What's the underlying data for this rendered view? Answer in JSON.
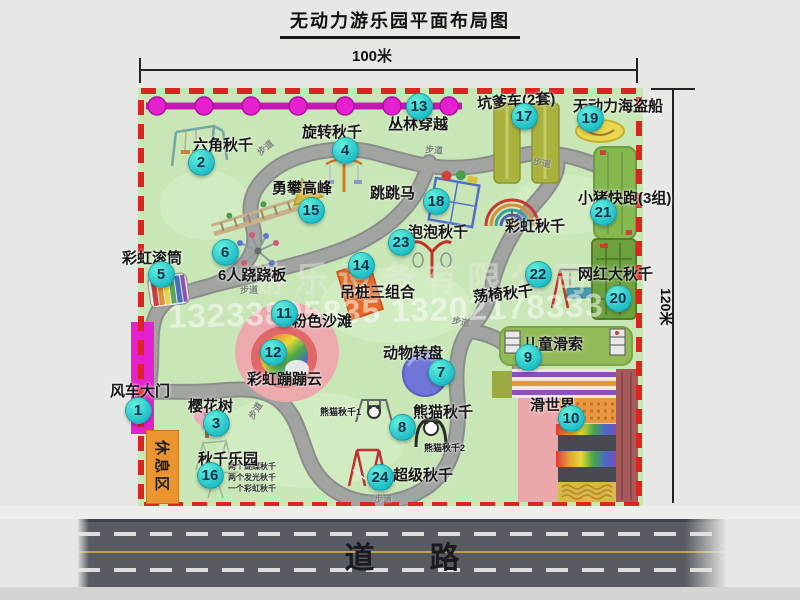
{
  "title": "无动力游乐园平面布局图",
  "dimensions": {
    "top": "100米",
    "right": "120米"
  },
  "road_label": "道路",
  "rest_area_label": "休息区",
  "path_label": "步道",
  "watermark": {
    "company": "游乐设备有限公司",
    "phones": "13233805835 13202178333"
  },
  "attractions": [
    {
      "num": 1,
      "name": "风车大门",
      "bx": 138,
      "by": 410,
      "lx": 110,
      "ly": 380
    },
    {
      "num": 2,
      "name": "六角秋千",
      "bx": 201,
      "by": 162,
      "lx": 193,
      "ly": 134
    },
    {
      "num": 3,
      "name": "樱花树",
      "bx": 216,
      "by": 423,
      "lx": 188,
      "ly": 395
    },
    {
      "num": 4,
      "name": "旋转秋千",
      "bx": 345,
      "by": 150,
      "lx": 302,
      "ly": 121
    },
    {
      "num": 5,
      "name": "彩虹滚筒",
      "bx": 161,
      "by": 274,
      "lx": 122,
      "ly": 247
    },
    {
      "num": 6,
      "name": "6人跷跷板",
      "bx": 225,
      "by": 252,
      "lx": 218,
      "ly": 264
    },
    {
      "num": 7,
      "name": "动物转盘",
      "bx": 441,
      "by": 372,
      "lx": 383,
      "ly": 342
    },
    {
      "num": 8,
      "name": "熊猫秋千",
      "bx": 402,
      "by": 427,
      "lx": 413,
      "ly": 401
    },
    {
      "num": 9,
      "name": "儿童滑索",
      "bx": 528,
      "by": 357,
      "lx": 523,
      "ly": 333
    },
    {
      "num": 10,
      "name": "滑世界",
      "bx": 571,
      "by": 418,
      "lx": 530,
      "ly": 394
    },
    {
      "num": 11,
      "name": "粉色沙滩",
      "bx": 284,
      "by": 313,
      "lx": 292,
      "ly": 310
    },
    {
      "num": 12,
      "name": "彩虹蹦蹦云",
      "bx": 273,
      "by": 352,
      "lx": 247,
      "ly": 368
    },
    {
      "num": 13,
      "name": "丛林穿越",
      "bx": 419,
      "by": 106,
      "lx": 388,
      "ly": 113
    },
    {
      "num": 14,
      "name": "吊桩三组合",
      "bx": 361,
      "by": 265,
      "lx": 340,
      "ly": 281
    },
    {
      "num": 15,
      "name": "勇攀高峰",
      "bx": 311,
      "by": 210,
      "lx": 272,
      "ly": 177
    },
    {
      "num": 16,
      "name": "秋千乐园",
      "bx": 210,
      "by": 475,
      "lx": 198,
      "ly": 448
    },
    {
      "num": 17,
      "name": "坑爹车(2套)",
      "bx": 524,
      "by": 116,
      "lx": 477,
      "ly": 90,
      "lrot": -4
    },
    {
      "num": 18,
      "name": "跳跳马",
      "bx": 436,
      "by": 201,
      "lx": 370,
      "ly": 182
    },
    {
      "num": 19,
      "name": "无动力海盗船",
      "bx": 590,
      "by": 118,
      "lx": 573,
      "ly": 95
    },
    {
      "num": 20,
      "name": "网红大秋千",
      "bx": 618,
      "by": 298,
      "lx": 578,
      "ly": 263
    },
    {
      "num": 21,
      "name": "小猪快跑(3组)",
      "bx": 603,
      "by": 212,
      "lx": 578,
      "ly": 187
    },
    {
      "num": 22,
      "name": "荡椅秋千",
      "bx": 538,
      "by": 274,
      "lx": 473,
      "ly": 283,
      "lrot": -6
    },
    {
      "num": 23,
      "name": "泡泡秋千",
      "bx": 401,
      "by": 242,
      "lx": 408,
      "ly": 221
    },
    {
      "num": 24,
      "name": "超级秋千",
      "bx": 380,
      "by": 477,
      "lx": 393,
      "ly": 464
    }
  ],
  "extra_labels": [
    {
      "key": "rainbow-swing",
      "text": "彩虹秋千",
      "x": 505,
      "y": 215
    },
    {
      "key": "panda-swing-1",
      "text": "熊猫秋千1",
      "x": 320,
      "y": 405,
      "small": true
    },
    {
      "key": "panda-swing-2",
      "text": "熊猫秋千2",
      "x": 424,
      "y": 441,
      "small": true
    }
  ],
  "swing_notes": [
    "两个蝴蝶秋千",
    "两个发光秋千",
    "一个彩虹秋千"
  ],
  "trail_positions": [
    {
      "x": 256,
      "y": 141,
      "r": -40
    },
    {
      "x": 425,
      "y": 143,
      "r": 4
    },
    {
      "x": 533,
      "y": 156,
      "r": 10
    },
    {
      "x": 240,
      "y": 283,
      "r": 0
    },
    {
      "x": 246,
      "y": 404,
      "r": -58
    },
    {
      "x": 452,
      "y": 315,
      "r": 12
    },
    {
      "x": 374,
      "y": 492,
      "r": 0
    }
  ]
}
